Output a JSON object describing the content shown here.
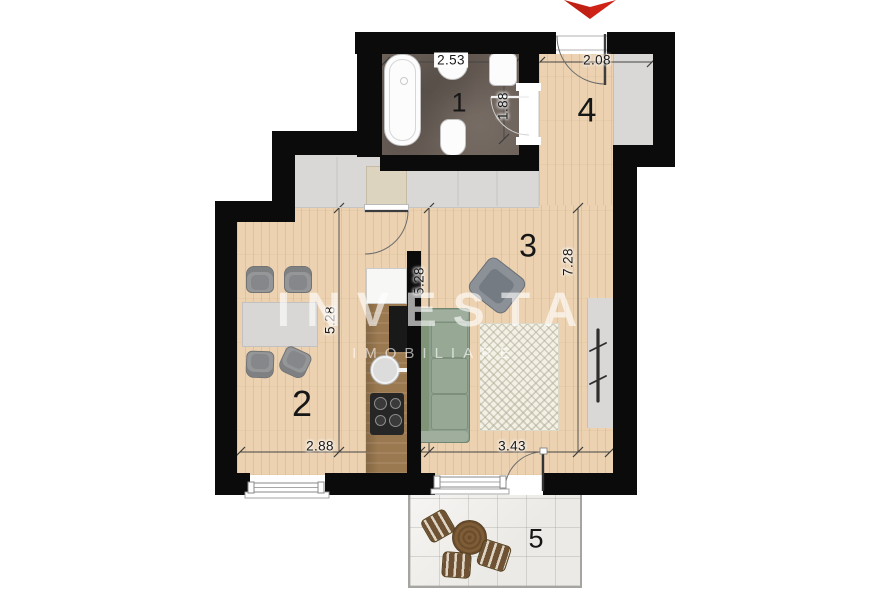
{
  "plan": {
    "type": "apartment-floor-plan",
    "watermark": {
      "line1": "INVESTA",
      "line2": "IMOBILIARE"
    },
    "entrance": {
      "marker": "red-down-arrow",
      "color": "#cf2318"
    },
    "rooms": [
      {
        "number": "1",
        "name": "bathroom",
        "floor": "dark-tile",
        "furniture": [
          "bathtub",
          "sink",
          "toilet",
          "washing-machine"
        ]
      },
      {
        "number": "2",
        "name": "kitchen-dining",
        "floor": "wood",
        "furniture": [
          "dining-table",
          "four-chairs",
          "fridge",
          "kitchen-counter",
          "kitchen-sink",
          "stove"
        ]
      },
      {
        "number": "3",
        "name": "living-room",
        "floor": "wood",
        "furniture": [
          "sofa",
          "armchair",
          "rug",
          "radiator"
        ]
      },
      {
        "number": "4",
        "name": "hallway",
        "floor": "wood",
        "furniture": [
          "entry-door",
          "wardrobe-niche"
        ]
      },
      {
        "number": "5",
        "name": "balcony",
        "floor": "stone-tile",
        "furniture": [
          "round-table",
          "three-chairs"
        ]
      }
    ],
    "dimensions": [
      {
        "id": "bathroom-width",
        "value": "2.53"
      },
      {
        "id": "hallway-width",
        "value": "2.08"
      },
      {
        "id": "bathroom-door-depth",
        "value": "1.88"
      },
      {
        "id": "room2-depth",
        "value": "5.28"
      },
      {
        "id": "room3-depth-left",
        "value": "5.28"
      },
      {
        "id": "room3-depth-right",
        "value": "7.28"
      },
      {
        "id": "room2-width",
        "value": "2.88"
      },
      {
        "id": "room3-width",
        "value": "3.43"
      }
    ],
    "palette": {
      "wall": "#0b0b0b",
      "wood": "#ecd2b1",
      "tile_dark": "#6c6159",
      "gray_area": "#d9d8d6",
      "balcony_floor": "#eceae6",
      "accent_red": "#cf2318"
    }
  }
}
